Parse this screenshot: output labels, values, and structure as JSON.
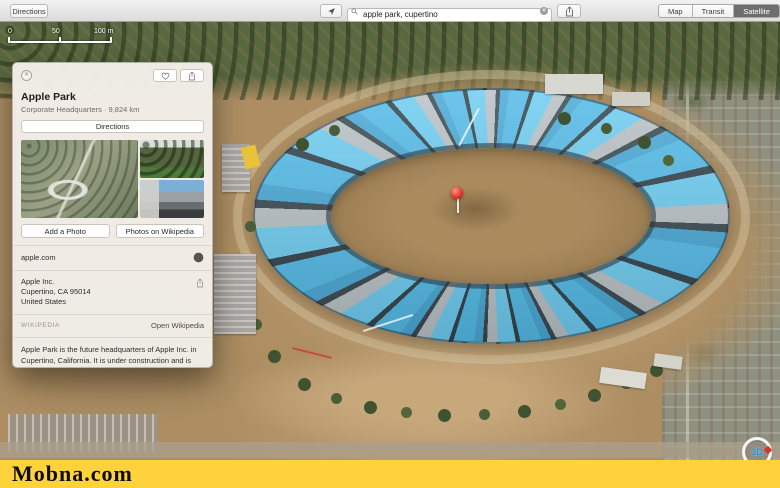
{
  "toolbar": {
    "directions_label": "Directions",
    "search_value": "apple park, cupertino",
    "segments": [
      {
        "label": "Map"
      },
      {
        "label": "Transit"
      },
      {
        "label": "Satellite"
      }
    ],
    "selected_segment": "Satellite"
  },
  "scale_bar": {
    "labels": [
      "0",
      "50",
      "100 m"
    ]
  },
  "map": {
    "compass_label": "3D",
    "pin_color": "#e2342a"
  },
  "info_card": {
    "title": "Apple Park",
    "subtitle": "Corporate Headquarters · 9,824 km",
    "directions_label": "Directions",
    "add_photo_label": "Add a Photo",
    "wikipedia_photos_label": "Photos on Wikipedia",
    "website": "apple.com",
    "address_line1": "Apple Inc.",
    "address_line2": "Cupertino, CA 95014",
    "address_line3": "United States",
    "wikipedia_heading": "WIKIPEDIA",
    "open_wikipedia_label": "Open Wikipedia",
    "wikipedia_text": "Apple Park is the future headquarters of Apple Inc. in Cupertino, California. It is under construction and is expected to be completed by the end of Q1 2017, and start to be occupied in early 2017."
  },
  "watermark": "Mobna.com",
  "colors": {
    "toolbar_selected_segment": "#6d6d6d",
    "panel_blue": "#54bbe8",
    "yellow_bar": "#fdd23a",
    "pin_red": "#e2342a"
  }
}
